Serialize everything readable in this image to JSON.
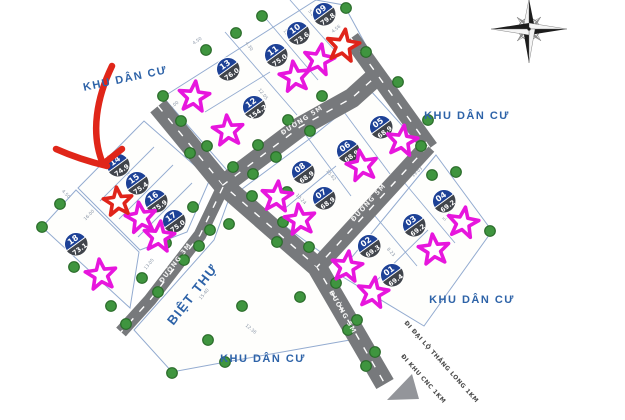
{
  "region_labels": [
    "KHU DÂN CƯ",
    "KHU DÂN CƯ",
    "KHU DÂN CƯ",
    "KHU DÂN CƯ",
    "BIỆT THỰ"
  ],
  "road_labels": [
    "ĐƯỜNG 5M",
    "ĐƯỜNG 5M",
    "ĐƯỜNG 5M",
    "ĐƯỜNG 3M"
  ],
  "direction_labels": [
    "ĐI ĐẠI LỘ THĂNG LONG 1KM",
    "ĐI KHU CNC 1KM"
  ],
  "plots": [
    {
      "id": "09",
      "area": "79.8"
    },
    {
      "id": "10",
      "area": "73.6"
    },
    {
      "id": "11",
      "area": "75.0"
    },
    {
      "id": "13",
      "area": "76.0"
    },
    {
      "id": "12",
      "area": "154.2"
    },
    {
      "id": "05",
      "area": "68.9"
    },
    {
      "id": "06",
      "area": "68.9"
    },
    {
      "id": "08",
      "area": "68.9"
    },
    {
      "id": "07",
      "area": "68.9"
    },
    {
      "id": "04",
      "area": "69.2"
    },
    {
      "id": "03",
      "area": "69.2"
    },
    {
      "id": "02",
      "area": "69.3"
    },
    {
      "id": "01",
      "area": "69.4"
    },
    {
      "id": "14",
      "area": "74.9"
    },
    {
      "id": "15",
      "area": "75.4"
    },
    {
      "id": "16",
      "area": "75.9"
    },
    {
      "id": "17",
      "area": "75.0"
    },
    {
      "id": "18",
      "area": "73.1"
    }
  ],
  "markers": {
    "magenta_stars": 15,
    "red_stars": 2,
    "red_arrow": "hand-drawn arrow pointing at plot 14",
    "compass": "compass-rose",
    "exit_arrow": "road exit arrow bottom right"
  },
  "dimension_labels": [
    "4.50",
    "4.30",
    "15.21",
    "5.00",
    "4.56",
    "15.00",
    "16.36",
    "12.05",
    "5.08",
    "4.09",
    "15.62",
    "10.24",
    "19.03",
    "5.36",
    "8.23",
    "4.52",
    "5.00",
    "16.00",
    "13.05",
    "12.36",
    "15.40",
    "4.50"
  ],
  "colors": {
    "badge_blue": "#1d4196",
    "badge_dark": "#40444b",
    "road_gray": "#77797c",
    "tree_green": "#3f953f",
    "star_magenta": "#e716dd",
    "star_red": "#e0241a",
    "label_blue": "#2e63a8",
    "parcel_line": "#93abd0",
    "arrow_red": "#e02619",
    "exit_arrow_gray": "#93959a"
  }
}
